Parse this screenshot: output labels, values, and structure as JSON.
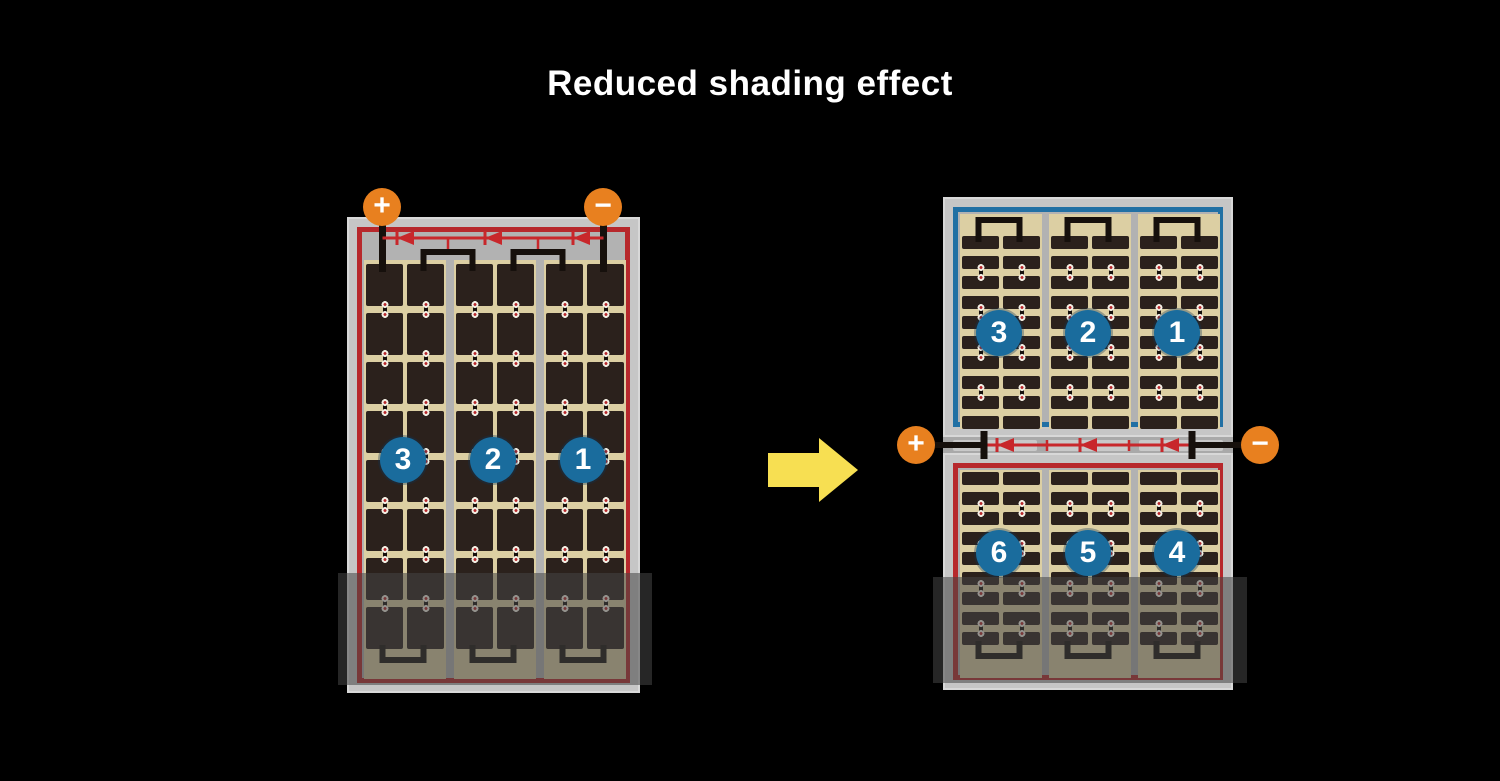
{
  "title": "Reduced shading effect",
  "left_module": {
    "terminals": {
      "positive": "+",
      "negative": "−"
    },
    "strings": [
      {
        "label": "3"
      },
      {
        "label": "2"
      },
      {
        "label": "1"
      }
    ]
  },
  "right_module": {
    "terminals": {
      "positive": "+",
      "negative": "−"
    },
    "top_strings": [
      {
        "label": "3"
      },
      {
        "label": "2"
      },
      {
        "label": "1"
      }
    ],
    "bottom_strings": [
      {
        "label": "6"
      },
      {
        "label": "5"
      },
      {
        "label": "4"
      }
    ]
  },
  "colors": {
    "background": "#000000",
    "title_text": "#ffffff",
    "module_frame_gray": "#c6c6c6",
    "inner_band_gray": "#b2b2b2",
    "cell_background_tan": "#dccfa3",
    "cell_dark": "#2b211c",
    "border_red": "#b7282c",
    "border_blue": "#2170a4",
    "wire_black": "#16100c",
    "wire_red": "#c8272b",
    "terminal_orange": "#e8801f",
    "string_badge_blue": "#1a6c9d",
    "arrow_yellow": "#f7df52",
    "shade_overlay": "rgba(70,70,70,0.55)"
  }
}
